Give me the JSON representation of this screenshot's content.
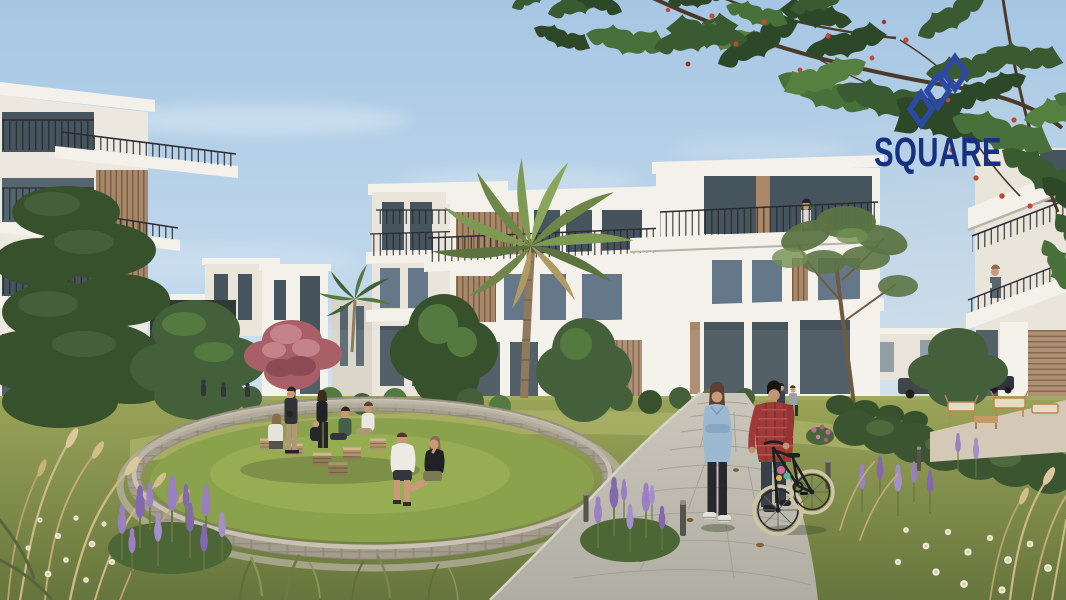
{
  "meta": {
    "kind": "architectural-render-photograph",
    "width_px": 1066,
    "height_px": 600,
    "scene": "Modern white terraced apartment buildings around a landscaped courtyard; group of people in a sunken circular seating area; couple with a bicycle on a stone garden path; palm and flame trees; developer logo watermark at top right"
  },
  "logo": {
    "text": "SQUARE",
    "mark": "interlocking-diamonds-monogram",
    "text_color": "#16327e",
    "mark_color": "#2b4aa5"
  },
  "palette": {
    "sky_top": "#a6c6e3",
    "sky_horizon": "#e2eef7",
    "foliage_dark": "#36512c",
    "foliage_light": "#5d7f49",
    "building_white": "#f3f1ea",
    "glass": "#46545d",
    "wood_slats": "#a9886a",
    "lawn": "#8ba24c",
    "stone": "#b6ae9d",
    "path": "#c3c0b6",
    "lavender": "#9a7fc2",
    "flame_flower_red": "#c14a33",
    "brand_navy": "#16327e"
  },
  "scene_objects": {
    "buildings": [
      "left-terraced-apartment",
      "mid-left-duplex-blocks",
      "garden-pavilion",
      "central-terraced-complex",
      "right-edge-apartment",
      "distant-parking-building"
    ],
    "trees": {
      "flame_tree_canopy": 1,
      "palms": 2,
      "pink_flowering": 1,
      "green_trees": 8,
      "pine": 1
    },
    "people": {
      "seating_circle_group": 9,
      "path_couple": 2,
      "path_walkers": 2,
      "balcony_residents": 2,
      "near_pavilion": 3
    },
    "vehicles": {
      "bicycles": 1,
      "cars": 3
    },
    "landscape": [
      "sunken-circular-seating",
      "wooden-crate-benches",
      "stone-path",
      "bollard-lights",
      "lavender",
      "daisies",
      "ornamental-grasses",
      "hedges",
      "outdoor-lounge-furniture"
    ]
  }
}
